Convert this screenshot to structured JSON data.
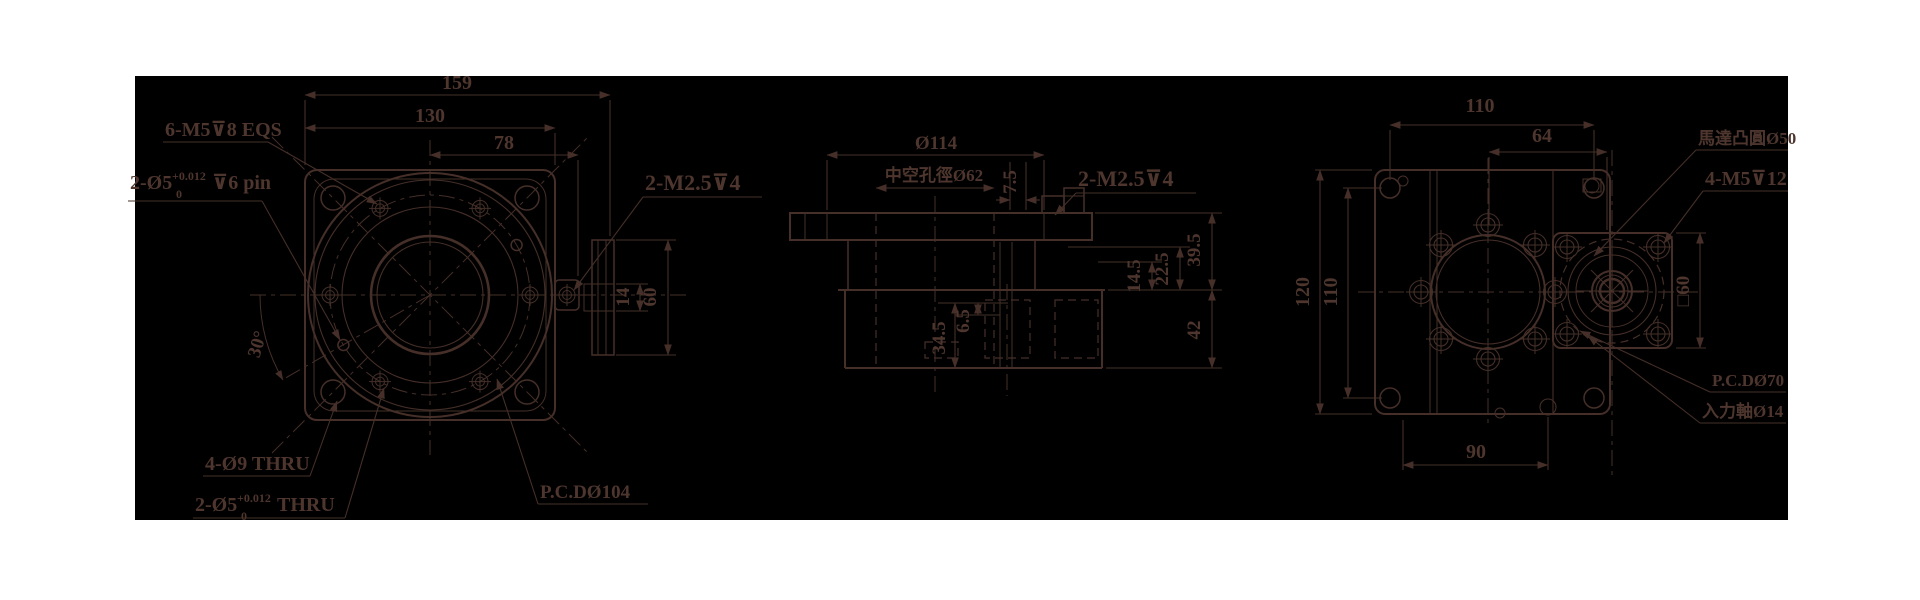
{
  "app": {
    "type": "cad-technical-drawing",
    "canvas_background": "#000000",
    "line_color": "#452f28",
    "text_color": "#4e362e"
  },
  "front_view": {
    "dims": {
      "overall_width": "159",
      "flange_width": "130",
      "half_width": "78",
      "tab_thickness": "14",
      "plate_height": "60",
      "pin_angle": "30°"
    },
    "labels": {
      "tap_holes": "6-M5⊽8 EQS",
      "pin_holes_prefix": "2-Ø5",
      "pin_tol_upper": "+0.012",
      "pin_tol_lower": "0",
      "pin_holes_suffix": "⊽6 pin",
      "corner_holes": "4-Ø9 THRU",
      "thru_pins_prefix": "2-Ø5",
      "thru_pins_tol_upper": "+0.012",
      "thru_pins_tol_lower": "0",
      "thru_pins_suffix": "THRU",
      "bolt_circle": "P.C.DØ104",
      "tab_taps": "2-M2.5⊽4"
    }
  },
  "section_view": {
    "dims": {
      "flange_diameter": "Ø114",
      "hollow_bore": "中空孔徑Ø62",
      "tab_offset": "7.5",
      "step_1": "14.5",
      "step_2": "22.5",
      "upper_height": "39.5",
      "lower_height": "42",
      "side_height": "34.5",
      "side_step": "6.5"
    },
    "labels": {
      "tab_taps": "2-M2.5⊽4"
    }
  },
  "side_view": {
    "dims": {
      "hole_span_width": "110",
      "motor_hole_span": "64",
      "body_height": "120",
      "hole_span_height": "110",
      "bottom_span": "90",
      "motor_square": "□60"
    },
    "labels": {
      "motor_boss": "馬達凸圓Ø50",
      "motor_taps": "4-M5⊽12",
      "motor_pcd": "P.C.DØ70",
      "input_shaft": "入力軸Ø14"
    }
  }
}
